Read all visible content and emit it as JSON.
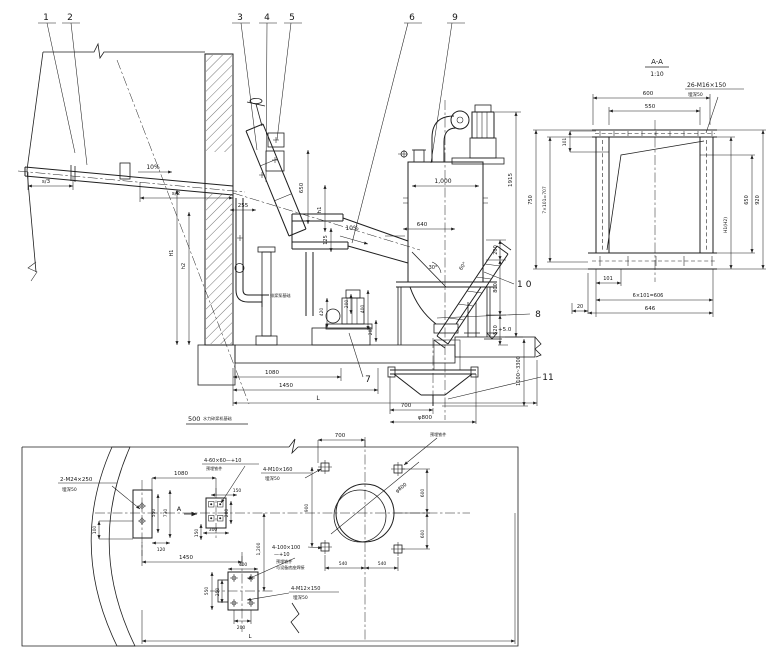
{
  "page": {
    "background": "#ffffff",
    "ink": "#1f1f1f"
  },
  "callouts": {
    "c1": "1",
    "c2": "2",
    "c3": "3",
    "c4": "4",
    "c5": "5",
    "c6": "6",
    "c7": "7",
    "c8": "8",
    "c9": "9",
    "c10": "10",
    "c11": "11"
  },
  "elevation": {
    "dims": {
      "s3": "s/3",
      "s2": "s/2",
      "slope_pipe": "10%",
      "slope_chute": "10%",
      "d255": "255",
      "d650": "650",
      "h1": "h1",
      "d125": "125",
      "d1000": "1,000",
      "d1915": "1915",
      "d640": "640",
      "ang30": "30°",
      "ang60": "60°",
      "d200_chain": "200",
      "d800_chain": "800",
      "d520_chain": "520",
      "d420": "420",
      "d200_pump": "200",
      "d400_pump": "400",
      "d200_base": "200",
      "dH1": "H1",
      "dh2": "h2",
      "d1080": "1080",
      "d1450": "1450",
      "dL": "L",
      "level": "+5.0",
      "d1100_3300": "1100~3300",
      "d700": "700",
      "dphi800": "φ800"
    },
    "notes": {
      "pump": "排浆泵基础",
      "title_num": "500",
      "title_text": "水力碎浆机基础"
    }
  },
  "section_aa": {
    "title": "A-A",
    "scale": "1:10",
    "bolt_spec": "26-M16×150",
    "bolt_embed": "埋深50",
    "dims": {
      "d600": "600",
      "d550": "550",
      "d101_top": "101",
      "d750": "750",
      "d707": "7×101=707",
      "d650": "650",
      "d920": "920",
      "dh": "H1(H2)",
      "d101_bot": "101",
      "d606": "6×101=606",
      "d646": "646",
      "d20": "20"
    }
  },
  "plan": {
    "marker_a": "A",
    "specs": {
      "m24": "2-M24×250",
      "m24_embed": "埋深50",
      "p6060": "4-60×60—+10",
      "p6060_note": "预埋铁件",
      "m10": "4-M10×160",
      "m10_embed": "埋深50",
      "p100": "4-100×100",
      "p100b": "—+10",
      "p100_note1": "预埋铁件",
      "p100_note2": "与设备底座焊接",
      "m12": "4-M12×150",
      "m12_embed": "埋深50",
      "embed_note": "预埋铁件"
    },
    "dims": {
      "d1080": "1080",
      "d150a": "150",
      "d550a": "550",
      "d730": "730",
      "d100": "100",
      "d120": "120",
      "d200a": "200",
      "d300": "300",
      "d150b": "150",
      "d1450": "1450",
      "d700": "700",
      "d900": "900",
      "d600a": "600",
      "d600b": "600",
      "d540a": "540",
      "d540b": "540",
      "dphi800": "φ800",
      "d1200": "1,200",
      "d400": "400",
      "d550b": "550",
      "d250": "250",
      "d200b": "200",
      "dL": "L"
    }
  }
}
